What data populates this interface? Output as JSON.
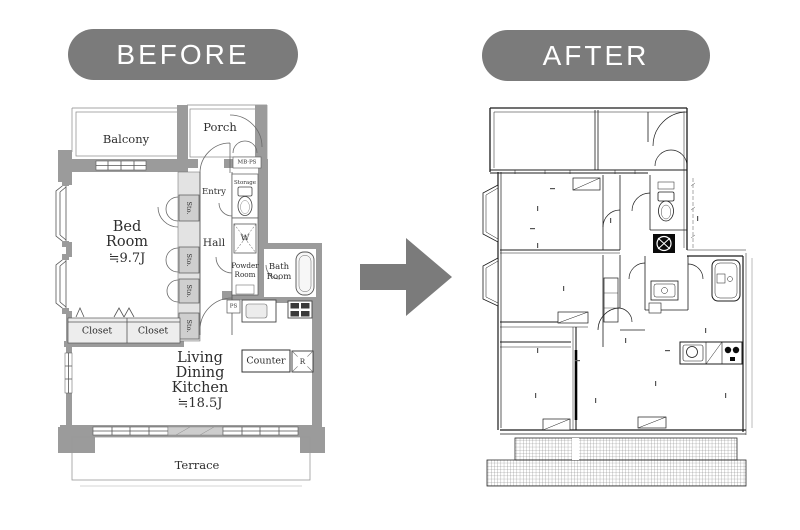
{
  "header": {
    "before_label": "BEFORE",
    "after_label": "AFTER"
  },
  "arrow": {
    "direction": "right",
    "color": "#7b7b7b"
  },
  "colors": {
    "page_bg": "#ffffff",
    "badge_bg": "#7b7b7b",
    "badge_text": "#ffffff",
    "before_wall": "#9b9b9b",
    "before_line": "#555555",
    "after_line": "#1c1c1c"
  },
  "before_plan": {
    "labels": {
      "balcony": "Balcony",
      "porch": "Porch",
      "mb_ps": "MB·PS",
      "storage": "Storage",
      "entry": "Entry",
      "sto": "Sto.",
      "bed_line1": "Bed",
      "bed_line2": "Room",
      "bed_size": "≒9.7J",
      "hall": "Hall",
      "washer": "W",
      "powder_line1": "Powder",
      "powder_line2": "Room",
      "bath_line1": "Bath",
      "bath_line2": "Room",
      "ps": "PS",
      "closet1": "Closet",
      "closet2": "Closet",
      "ldk_line1": "Living",
      "ldk_line2": "Dining",
      "ldk_line3": "Kitchen",
      "ldk_size": "≒18.5J",
      "counter": "Counter",
      "fridge": "R",
      "terrace": "Terrace"
    }
  },
  "after_plan": {
    "line_color": "#1c1c1c"
  }
}
